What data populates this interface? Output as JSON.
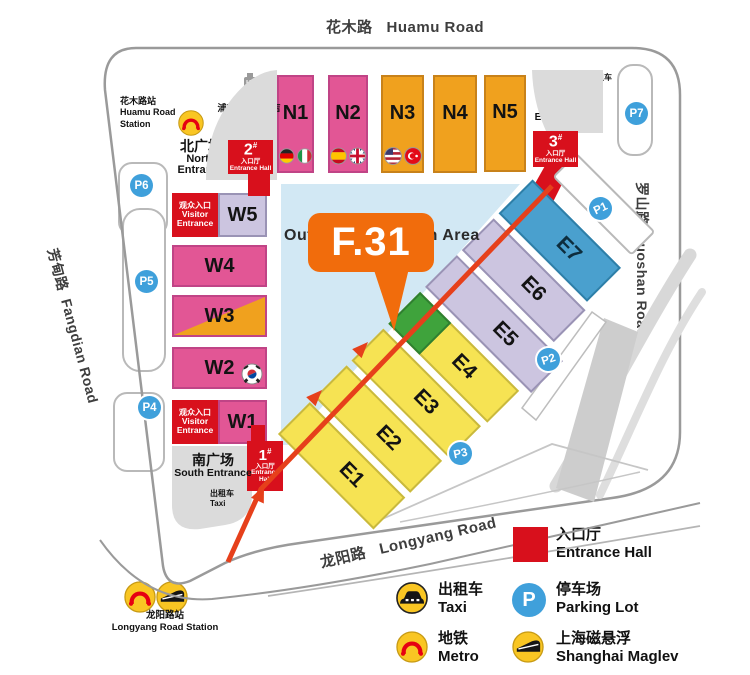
{
  "roads": {
    "huamu": {
      "zh": "花木路",
      "en": "Huamu Road"
    },
    "fangdian": {
      "zh": "芳甸路",
      "en": "Fangdian Road"
    },
    "luoshan": {
      "zh": "罗山路",
      "en": "Luoshan Road"
    },
    "longyang": {
      "zh": "龙阳路",
      "en": "Longyang Road"
    }
  },
  "stations": {
    "huamu": {
      "zh": "花木路站",
      "en1": "Huamu Road",
      "en2": "Station"
    },
    "longyang": {
      "zh": "龙阳路站",
      "en": "Longyang Road Station"
    }
  },
  "hotel": {
    "zh": "浦东嘉里大酒店",
    "en": "Kerry Hotel"
  },
  "plazas": {
    "north": {
      "zh": "北广场",
      "en1": "North",
      "en2": "Entrance"
    },
    "east": {
      "zh": "东广场",
      "en": "East Entrance"
    },
    "south": {
      "zh": "南广场",
      "en": "South Entrance"
    }
  },
  "taxi": {
    "zh": "出租车",
    "en": "Taxi"
  },
  "visitor": {
    "zh": "观众入口",
    "en1": "Visitor",
    "en2": "Entrance"
  },
  "entrance_halls": {
    "one": {
      "num": "1",
      "hash": "#",
      "zh": "入口厅",
      "en1": "Entrance",
      "en2": "Hall"
    },
    "two": {
      "num": "2",
      "hash": "#",
      "zh": "入口厅",
      "en": "Entrance Hall"
    },
    "three": {
      "num": "3",
      "hash": "#",
      "zh": "入口厅",
      "en": "Entrance Hall"
    }
  },
  "halls": {
    "north": [
      {
        "label": "N1",
        "flags": [
          "germany",
          "italy"
        ]
      },
      {
        "label": "N2",
        "flags": [
          "spain",
          "uk"
        ]
      },
      {
        "label": "N3",
        "flags": [
          "usa",
          "turkey"
        ]
      },
      {
        "label": "N4",
        "flags": []
      },
      {
        "label": "N5",
        "flags": []
      }
    ],
    "west": [
      {
        "label": "W5"
      },
      {
        "label": "W4"
      },
      {
        "label": "W3"
      },
      {
        "label": "W2",
        "flag": "south-korea"
      },
      {
        "label": "W1"
      }
    ],
    "east": [
      {
        "label": "E1"
      },
      {
        "label": "E2"
      },
      {
        "label": "E3"
      },
      {
        "label": "E4"
      },
      {
        "label": "E5"
      },
      {
        "label": "E6"
      },
      {
        "label": "E7"
      }
    ]
  },
  "parking": [
    "P1",
    "P2",
    "P3",
    "P4",
    "P5",
    "P6",
    "P7"
  ],
  "outdoor": {
    "label": "Outdoor Exhibition Area"
  },
  "marker": {
    "label": "F.31"
  },
  "legend": {
    "entrance": {
      "zh": "入口厅",
      "en": "Entrance Hall"
    },
    "taxi": {
      "zh": "出租车",
      "en": "Taxi"
    },
    "parking": {
      "zh": "停车场",
      "en": "Parking Lot"
    },
    "metro": {
      "zh": "地铁",
      "en": "Metro"
    },
    "maglev": {
      "zh": "上海磁悬浮",
      "en": "Shanghai Maglev"
    }
  },
  "colors": {
    "entrance_red": "#D8101C",
    "hall_pink": "#E25695",
    "hall_orange": "#F0A11E",
    "hall_yellow": "#F6E353",
    "hall_lavender": "#CCC5E0",
    "hall_blue": "#4AA0CE",
    "hall_green": "#3FA33C",
    "parking_blue": "#3FA0DB",
    "marker_orange": "#F16C0C",
    "route_red": "#E6401B",
    "outdoor_blue": "#D2E8F4",
    "plaza_gray": "#DBDBDB"
  }
}
